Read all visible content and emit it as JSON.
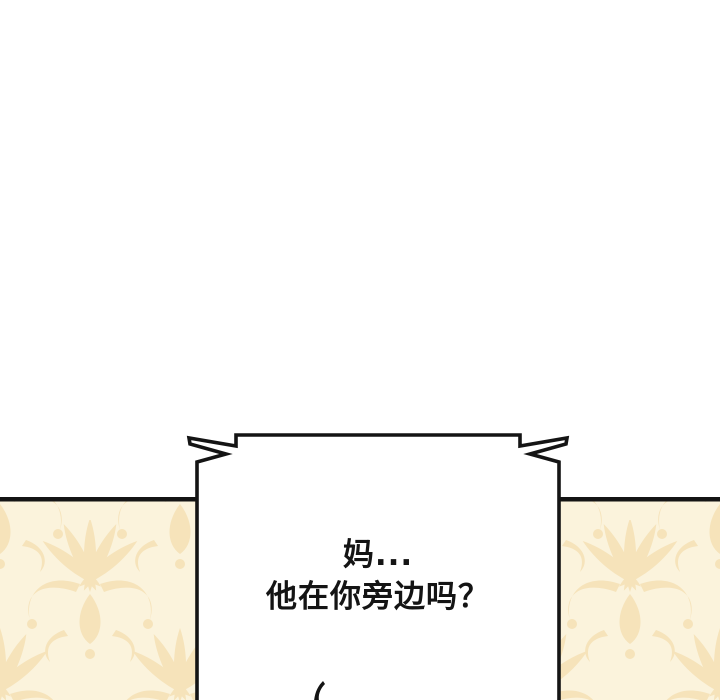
{
  "page": {
    "width": 720,
    "height": 700,
    "background": "#ffffff"
  },
  "panel": {
    "divider_color": "#141414",
    "wallpaper_base": "#fbf3dc",
    "wallpaper_motif": "#f6e3ba"
  },
  "speech_bubble": {
    "shape": "rectangular shout bubble with burst zigzag spikes at both top corners, open at bottom edge",
    "fill": "#ffffff",
    "stroke": "#141414",
    "lines": [
      "妈...",
      "他在你旁边吗？"
    ]
  },
  "artwork": {
    "pen_stroke": "tip of black line art entering panel from bottom edge",
    "color": "#141414"
  }
}
